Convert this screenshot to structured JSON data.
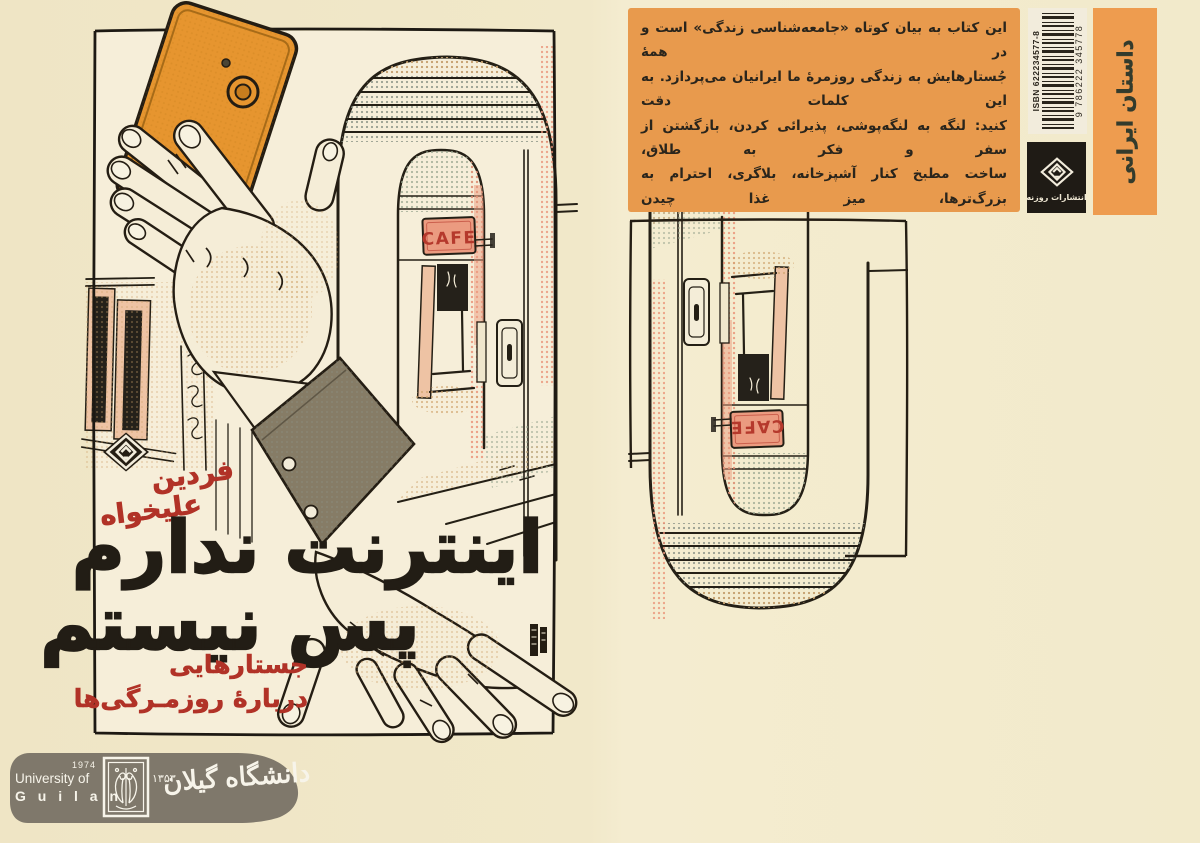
{
  "front_cover": {
    "author_line1": "فردین",
    "author_line2": "علیخواه",
    "title_line1": "اینترنت ندارم",
    "title_line2": "پس نیستم",
    "subtitle_line1": "جستارهایی",
    "subtitle_line2": "دربارهٔ روزمـرگی‌ها",
    "cafe_sign": "CAFE"
  },
  "back_cover": {
    "blurb_lines": [
      "این کتاب به بیان کوتاه «جامعه‌شناسی زندگی» است و در همهٔ",
      "جُستارهایش به زندگی روزمرهٔ ما ایرانیان می‌پردازد. به این کلمات دقت",
      "کنید: لنگه به لنگه‌پوشی، پذیرائی کردن، بازگشتن از سفر و فکر به طلاق،",
      "ساخت مطبخ کنار آشپزخانه، بلاگری، احترام به بزرگ‌ترها، میز غذا چیدن",
      "در جنگل، بی‌حوصلگی، معمولی شدن برای هم، عصبانیت از گذر سریع",
      "زمان، به ستوه آمدن از رنج خود و دیگران، بویدن و لمس آجرهای کهنه!",
      "همه و همه در این کتاب موضوع و بهانهٔ نوشتن شده‌اند؛ نوشتاری با نثری",
      "روان و به دور از قلمبه‌سلمبه‌گویی‌های رایج!"
    ],
    "isbn_label": "ISBN 622234577-8",
    "barcode_number": "9 786222 345778",
    "publisher_name": "انتشارات روزنه",
    "category_strip": "داستان ایرانی"
  },
  "watermark": {
    "university_en_line1": "University of",
    "university_en_line2": "G u i l a n",
    "year_en": "1974",
    "year_fa": "۱۳۵۳",
    "university_fa": "دانشگاه گیلان"
  },
  "colors": {
    "page_cream": "#f0e7c8",
    "cover_cream": "#f6eed9",
    "blurb_orange": "#e89a4d",
    "strip_orange": "#ee9c4f",
    "title_black": "#221d15",
    "accent_red": "#b13227",
    "phone_orange": "#e6952f",
    "cafe_sign_red": "#b5392c",
    "banner_taupe": "#7b7468"
  }
}
